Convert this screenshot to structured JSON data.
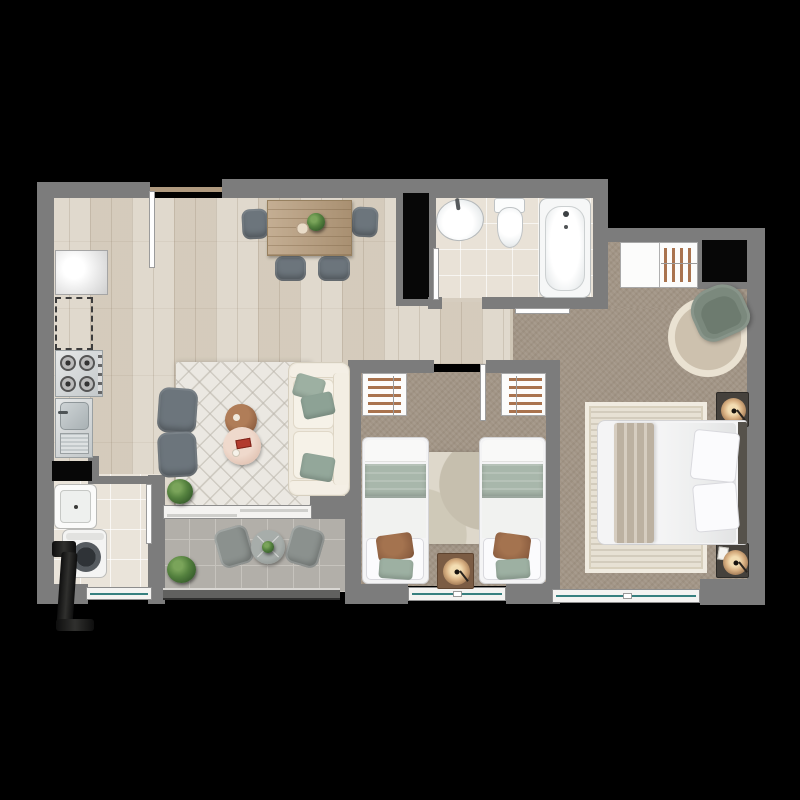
{
  "meta": {
    "kind": "apartment-floor-plan",
    "visible_text": "none",
    "background": "#000000"
  },
  "palette": {
    "wall_gray": "#7c7c7c",
    "wood_floor": "#dcd4c6",
    "bath_tile": "#e9e2d7",
    "laundry_tile": "#eae4da",
    "terrace_tile": "#b2afa9",
    "bedroom_carpet": "#a29586",
    "rug_light": "#ebe8e2",
    "window_glass": "#37807f",
    "door_leaf": "#fefefe",
    "sage_accent": "#9db0a2",
    "terracotta_accent": "#8d5f41",
    "lamp_glow": "#d9b183",
    "plant_green": "#55823f",
    "wood_furniture": "#b79c7b",
    "shaft_black": "#070707"
  },
  "rooms": {
    "kitchen_living_dining": {
      "name": "kitchen living dining",
      "floor": "wood",
      "furniture": [
        "refrigerator-icon",
        "dishwasher-dashed-icon",
        "stove-icon",
        "kitchen-sink-icon",
        "counter-icon",
        "dining-table-icon",
        "dining-chair-icon",
        "dining-chair-icon",
        "dining-chair-icon",
        "dining-chair-icon",
        "table-plant-icon",
        "plate-icon",
        "area-rug-icon",
        "armchair-icon",
        "armchair-icon",
        "coffee-table-icon",
        "side-table-icon",
        "sofa-icon",
        "throw-pillow-icon",
        "plant-icon"
      ]
    },
    "hallway": {
      "name": "hallway",
      "floor": "wood",
      "furniture": []
    },
    "bathroom": {
      "name": "bathroom",
      "floor": "beige-tile",
      "furniture": [
        "washbasin-icon",
        "toilet-icon",
        "bathtub-icon",
        "door-leaf-icon"
      ]
    },
    "bedroom_second": {
      "name": "second bedroom",
      "floor": "carpet",
      "furniture": [
        "wardrobe-hangers-icon",
        "wardrobe-hangers-icon",
        "single-bed-icon",
        "single-bed-icon",
        "accent-rug-icon",
        "nightstand-icon",
        "lamp-icon",
        "door-leaf-icon",
        "window-icon"
      ]
    },
    "bedroom_master": {
      "name": "master bedroom",
      "floor": "carpet",
      "furniture": [
        "wardrobe-hangers-icon",
        "duct-shaft-icon",
        "round-rug-icon",
        "armchair-icon",
        "nightstand-icon",
        "lamp-icon",
        "double-bed-icon",
        "bed-rug-icon",
        "nightstand-icon",
        "lamp-icon",
        "notepad-icon",
        "window-icon",
        "door-leaf-icon"
      ]
    },
    "terrace": {
      "name": "terrace",
      "floor": "gray-tile",
      "furniture": [
        "bistro-table-icon",
        "outdoor-chair-icon",
        "outdoor-chair-icon",
        "plant-icon",
        "sliding-door-icon",
        "railing-icon"
      ]
    },
    "laundry": {
      "name": "laundry",
      "floor": "light-tile",
      "furniture": [
        "laundry-tub-icon",
        "washing-machine-icon",
        "vent-pipe-icon",
        "door-leaf-icon",
        "window-icon"
      ]
    },
    "service": {
      "name": "ducts",
      "furniture": [
        "duct-shaft-icon",
        "duct-shaft-icon"
      ]
    }
  },
  "openings": {
    "entry_doors": 1,
    "interior_doors": 4,
    "sliding_doors": 1,
    "windows": 3
  }
}
